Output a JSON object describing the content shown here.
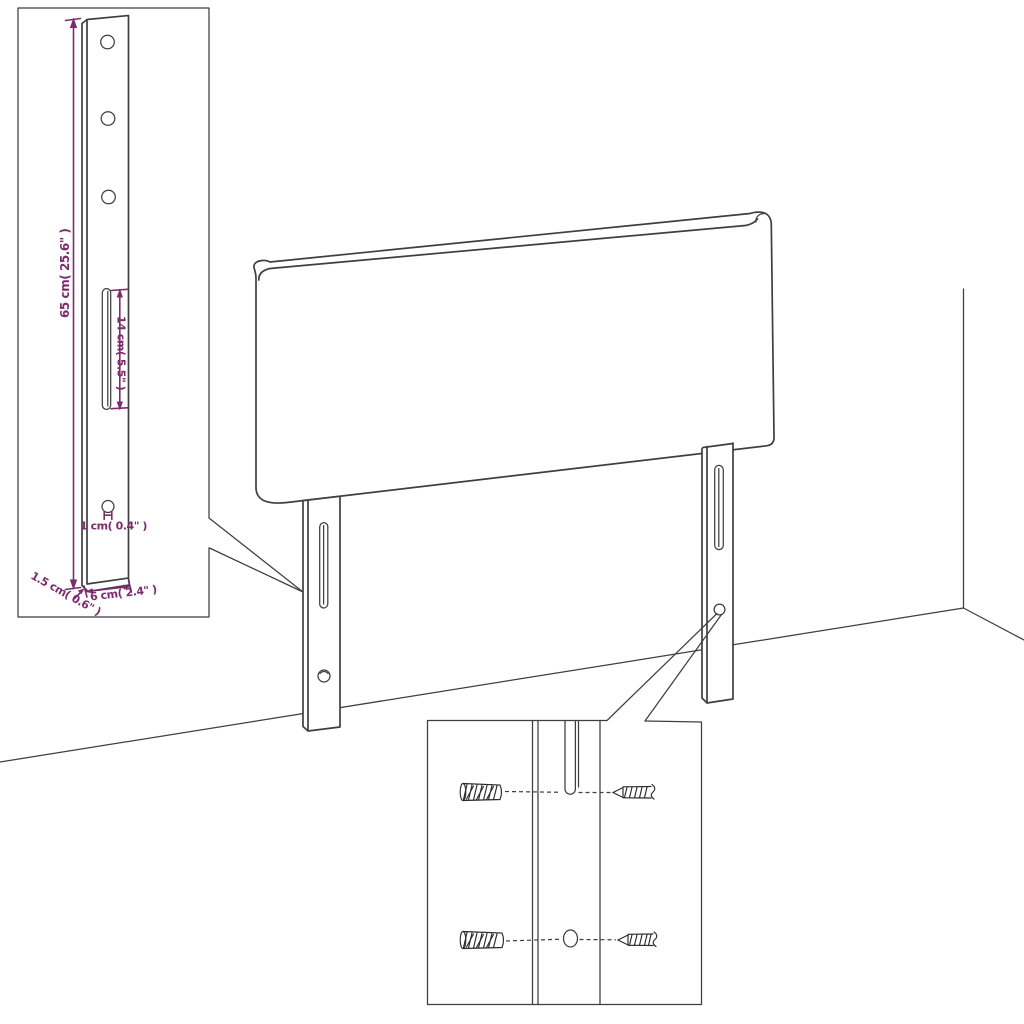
{
  "diagram": {
    "type": "furniture assembly dimension diagram",
    "subject": "upholstered headboard with two wall-mount legs, room-corner perspective",
    "background": "#ffffff",
    "line_color": "#3f3f3f",
    "dimension_color": "#7c2c6c",
    "labels": {
      "total_height": "65 cm( 25.6\" )",
      "slot_length": "14 cm( 5.5\" )",
      "hole_diameter": "1 cm( 0.4\" )",
      "side_depth": "1.5 cm( 0.6\" )",
      "leg_width": "6 cm( 2.4\" )"
    },
    "icons": {
      "wall_plug": "wall-plug-icon",
      "screw": "screw-icon"
    },
    "insets": {
      "leg_detail": "leg with 3 screw holes, long slot, small hole",
      "hardware_detail": "wall plugs and screws aligned to leg slot and hole"
    }
  }
}
